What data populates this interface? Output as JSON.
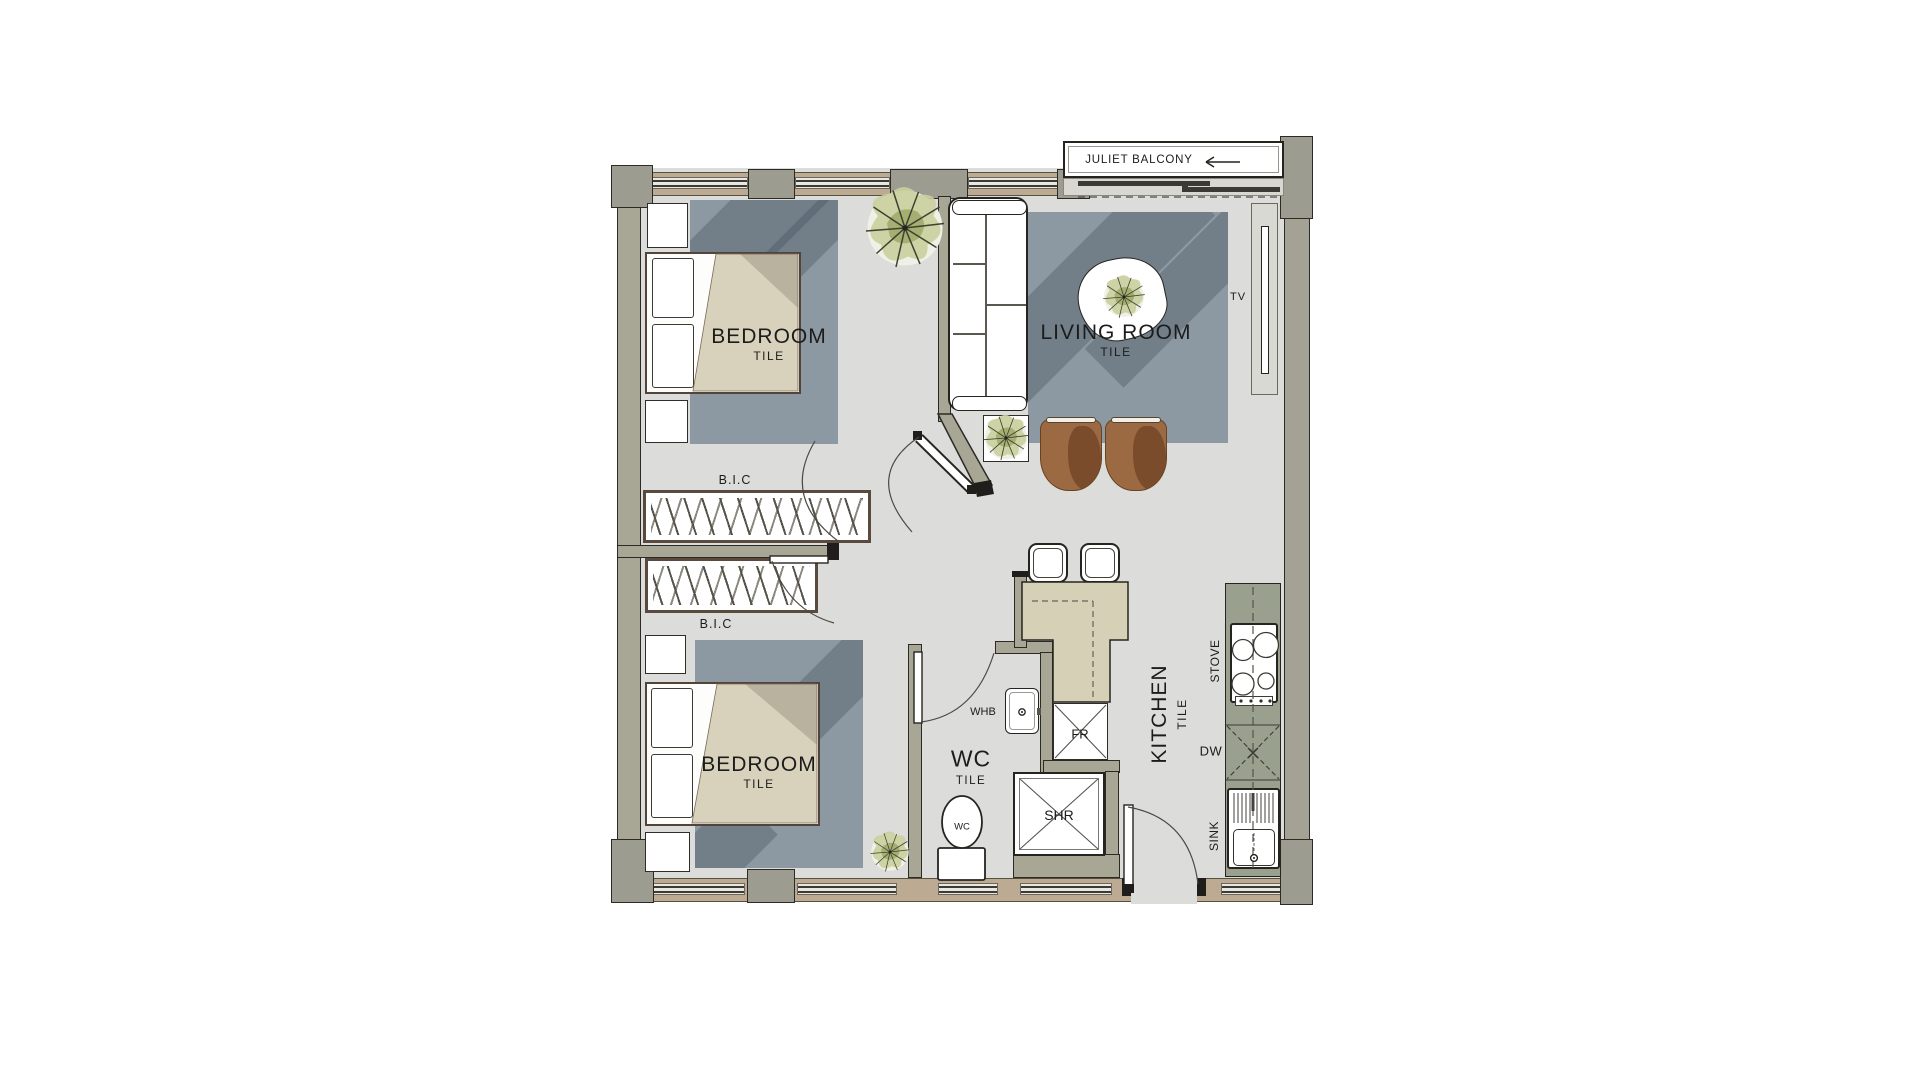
{
  "plan_title": "apartment floor plan",
  "balcony": {
    "label": "JULIET BALCONY"
  },
  "icons": {
    "balcony_arrow": "left-arrow-icon"
  },
  "rooms": [
    {
      "id": "bedroom-1",
      "name": "BEDROOM",
      "finish": "TILE"
    },
    {
      "id": "bedroom-2",
      "name": "BEDROOM",
      "finish": "TILE"
    },
    {
      "id": "living-room",
      "name": "LIVING ROOM",
      "finish": "TILE"
    },
    {
      "id": "kitchen",
      "name": "KITCHEN",
      "finish": "TILE"
    },
    {
      "id": "wc",
      "name": "WC",
      "finish": "TILE"
    }
  ],
  "closets": [
    "B.I.C",
    "B.I.C"
  ],
  "fixtures": {
    "tv": "TV",
    "stove": "STOVE",
    "dishwasher": "DW",
    "sink": "SINK",
    "wash_basin": "WHB",
    "fridge": "FR",
    "shower": "SHR",
    "toilet": "WC"
  },
  "colors": {
    "floor": "#dcdcda",
    "wall": "#a8a795",
    "exterior_band": "#bcaa93",
    "pier": "#9c9c91",
    "rug": "#8d99a2",
    "bed_duvet": "#d8d2bc",
    "counter": "#99a08e",
    "peninsula": "#d6d0b7",
    "chair": "#9c6a42",
    "outline": "#26241f"
  }
}
